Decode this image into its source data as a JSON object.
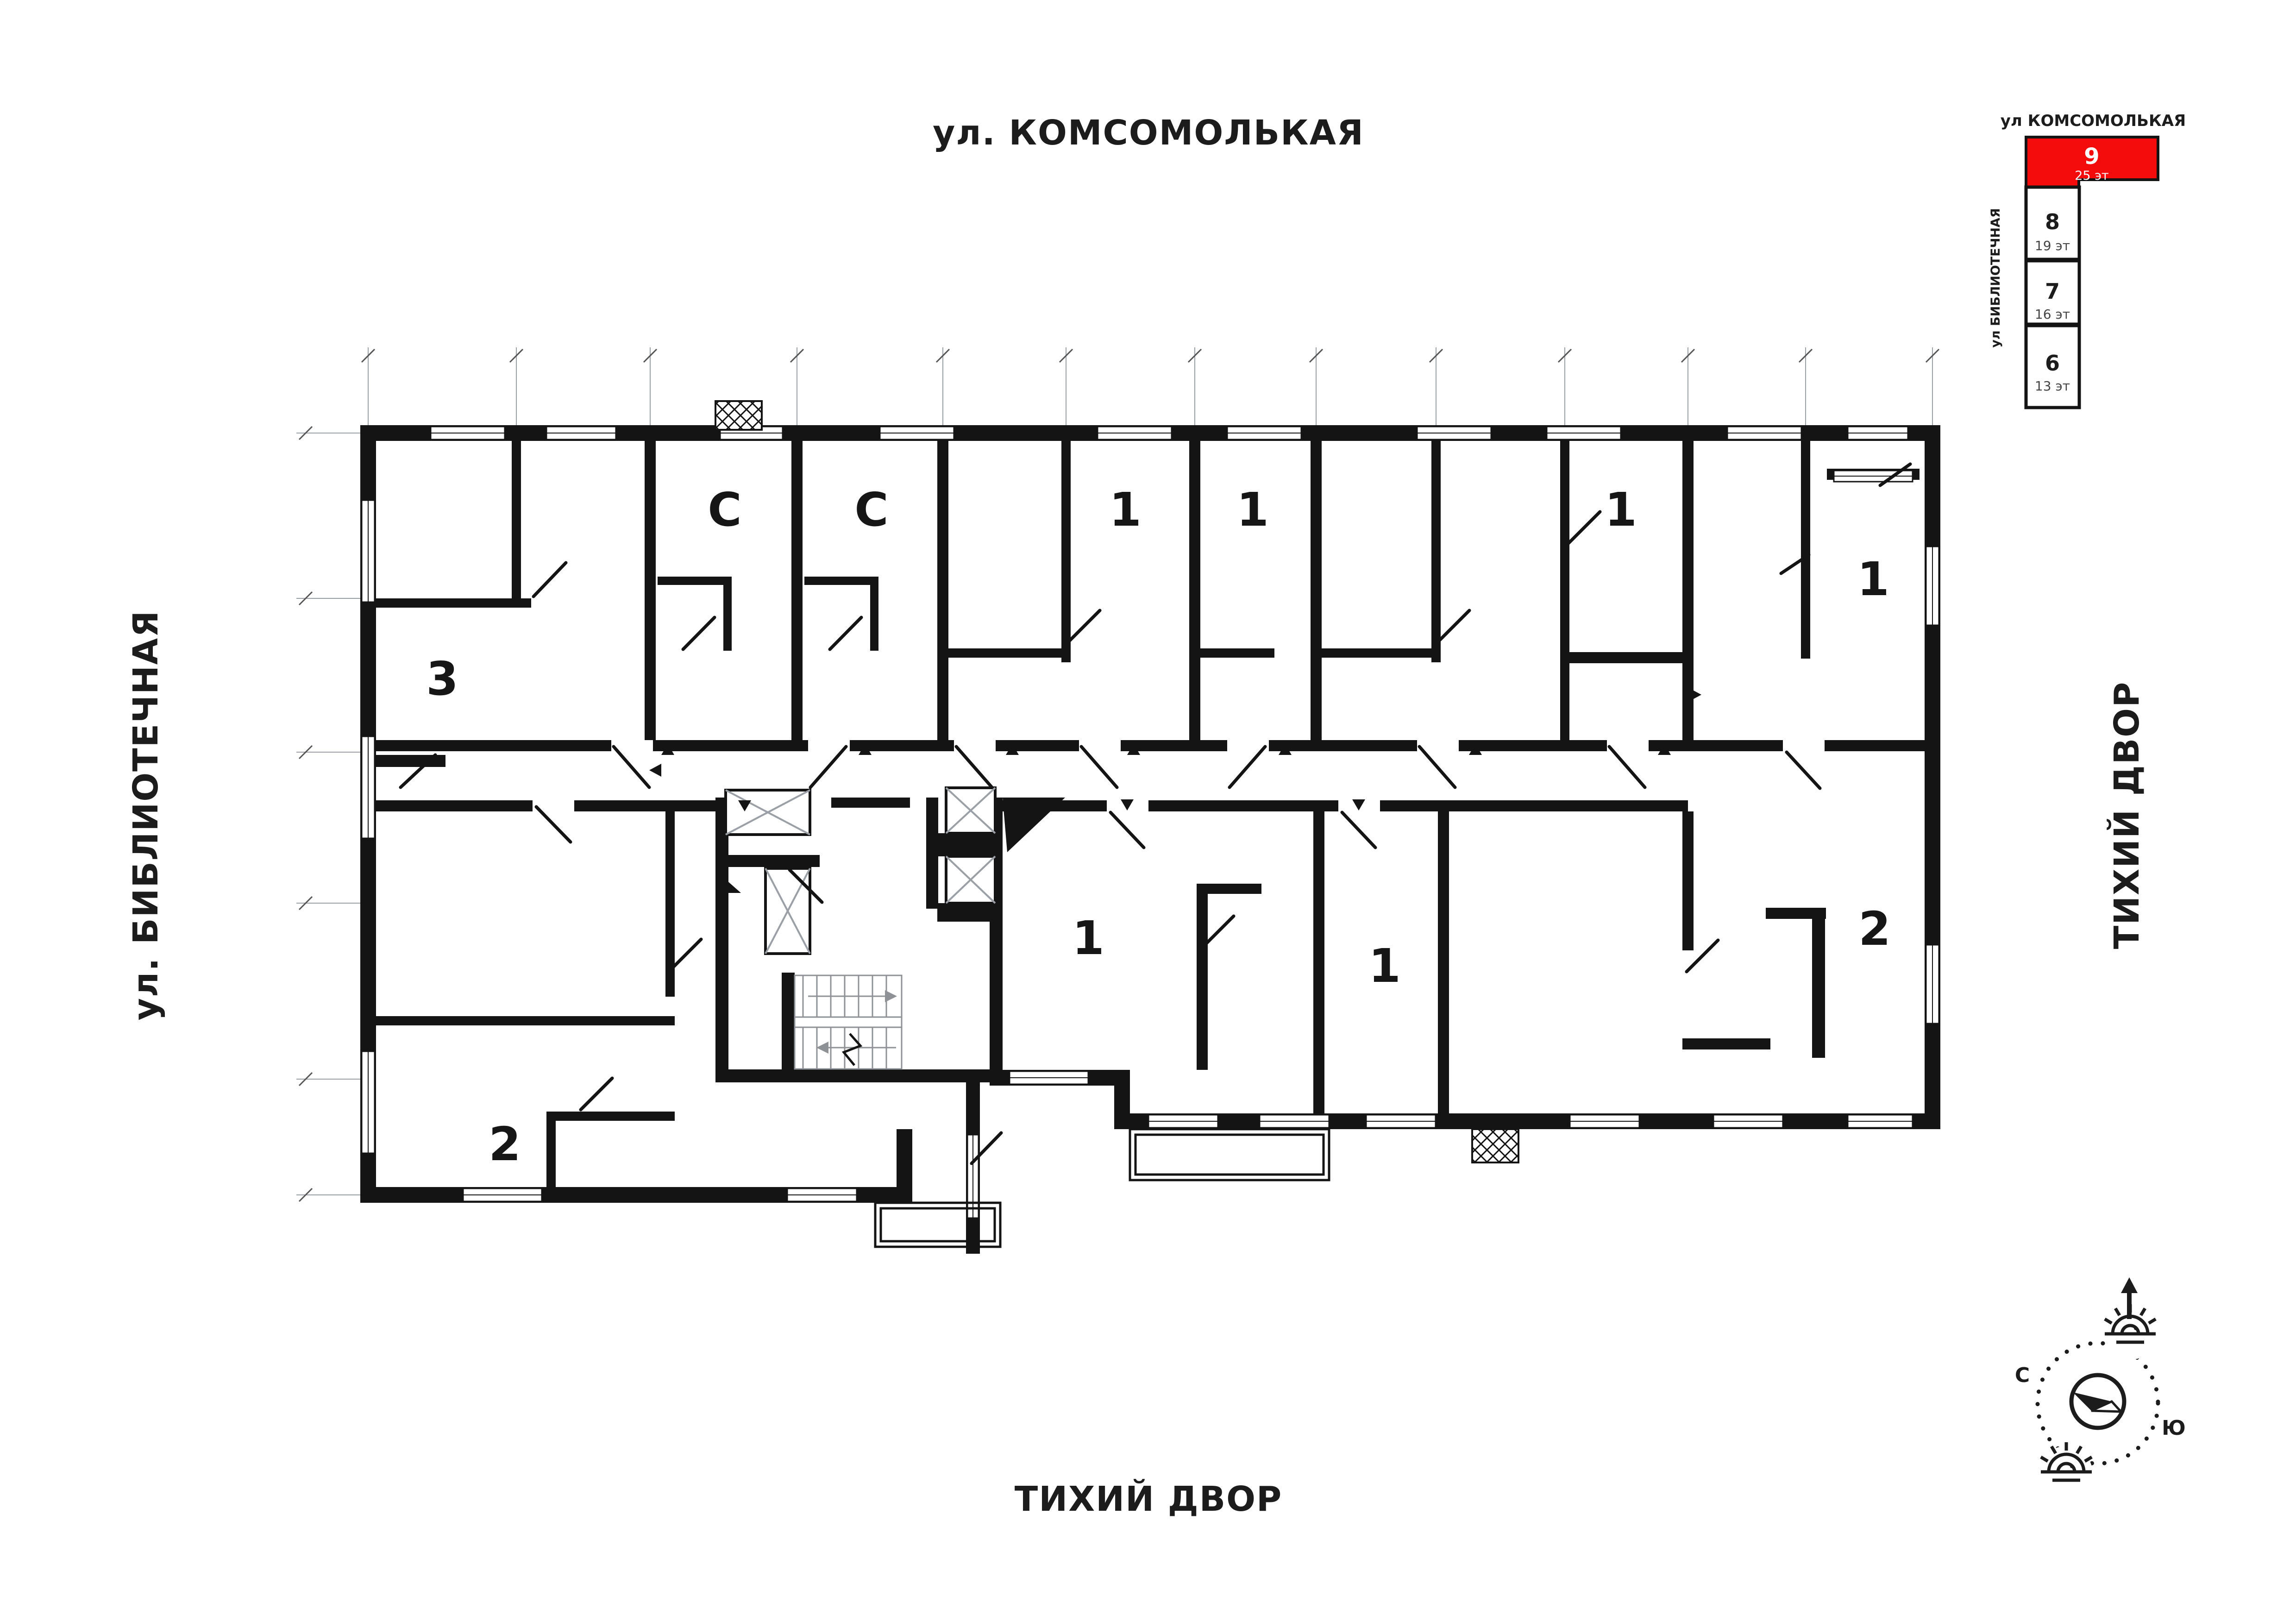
{
  "streets": {
    "top": "ул. КОМСОМОЛЬКАЯ",
    "left": "ул. БИБЛИОТЕЧНАЯ",
    "bottom": "ТИХИЙ ДВОР",
    "right": "ТИХИЙ ДВОР"
  },
  "minimap": {
    "header": "ул КОМСОМОЛЬКАЯ",
    "side_street": "ул БИБЛИОТЕЧНАЯ",
    "highlight_color": "#F40B0B",
    "blocks": [
      {
        "num": "9",
        "floors": "25 эт",
        "active": true
      },
      {
        "num": "8",
        "floors": "19 эт",
        "active": false
      },
      {
        "num": "7",
        "floors": "16 эт",
        "active": false
      },
      {
        "num": "6",
        "floors": "13 эт",
        "active": false
      }
    ]
  },
  "compass": {
    "north_label": "С",
    "south_label": "Ю"
  },
  "plan": {
    "unit_labels": [
      {
        "type": "3"
      },
      {
        "type": "С"
      },
      {
        "type": "С"
      },
      {
        "type": "1"
      },
      {
        "type": "1"
      },
      {
        "type": "1"
      },
      {
        "type": "1"
      },
      {
        "type": "2"
      },
      {
        "type": "1"
      },
      {
        "type": "1"
      },
      {
        "type": "2"
      }
    ]
  }
}
